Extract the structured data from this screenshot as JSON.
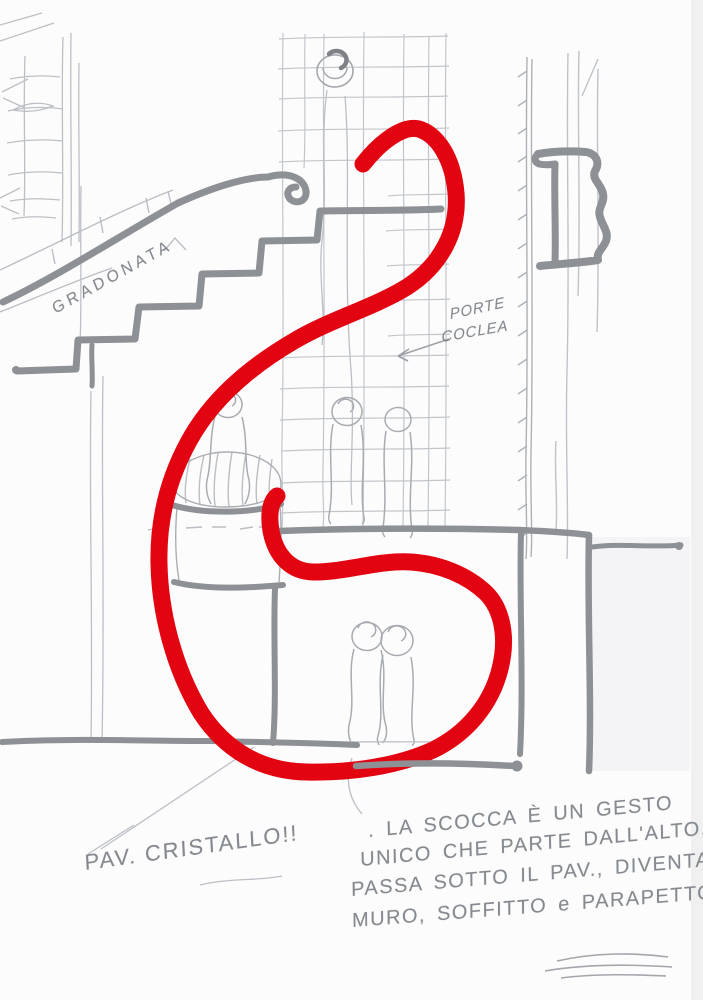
{
  "annotations": {
    "stair_label": "GRADONATA",
    "door_label_line1": "PORTE",
    "door_label_line2": "COCLEA",
    "floor_label": "PAV. CRISTALLO!!",
    "note": {
      "line1": ". LA SCOCCA È UN GESTO",
      "line2": "UNICO CHE PARTE DALL'ALTO,",
      "line3": "PASSA SOTTO IL PAV., DIVENTA",
      "line4": "MURO, SOFFITTO e PARAPETTO!!"
    }
  },
  "colors": {
    "red_marker": "#e30411",
    "gray_marker": "#8d9094",
    "pencil": "#b6bac0",
    "paper": "#fcfcfc"
  }
}
